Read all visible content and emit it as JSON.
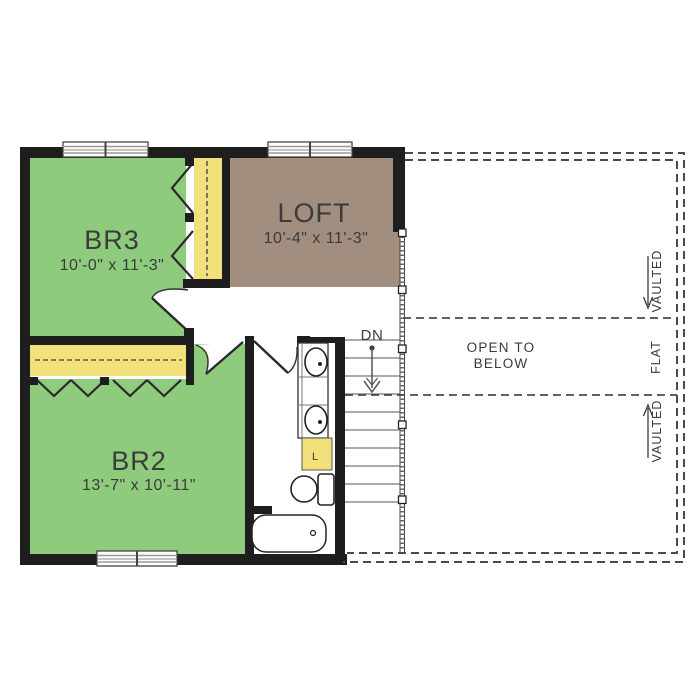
{
  "rooms": {
    "br3": {
      "label": "BR3",
      "dims": "10'-0\" x 11'-3\""
    },
    "loft": {
      "label": "LOFT",
      "dims": "10'-4\" x 11'-3\""
    },
    "br2": {
      "label": "BR2",
      "dims": "13'-7\" x 10'-11\""
    }
  },
  "labels": {
    "open_below_1": "OPEN TO",
    "open_below_2": "BELOW",
    "down": "DN",
    "vaulted_upper": "VAULTED",
    "flat": "FLAT",
    "vaulted_lower": "VAULTED",
    "linen": "L"
  },
  "colors": {
    "bedroom": "#8FCB7D",
    "loft": "#A28E7E",
    "closet": "#F2E17B",
    "wall": "#1E1E1E",
    "annotation": "#3B3B3B"
  }
}
